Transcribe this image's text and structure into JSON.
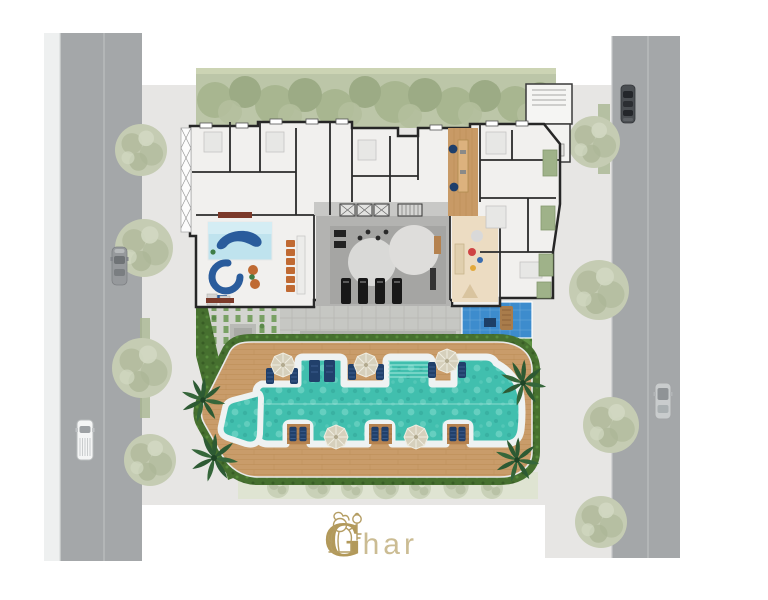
{
  "logo": {
    "initial": "G",
    "rest": "har",
    "icon": "lion-key-icon",
    "gold": "#b2995a",
    "gold_light": "#cbbc93"
  },
  "palette": {
    "road_asphalt": "#a4a7a9",
    "sidewalk": "#eef0f0",
    "site_ground": "#e7e6e4",
    "hedge_top": "#bcc6a8",
    "hedge_dark": "#46702f",
    "foliage_sage": "#c5ccb3",
    "deck_wood": "#c99c6a",
    "pool_water": "#41bfae",
    "pool_coping": "#eef2f2",
    "plunge_pool_blue": "#3d8ccd",
    "grass": "#5f9344",
    "building_wall": "#262626",
    "room_floor": "#f1f0ee",
    "core_gray": "#b3b3b1",
    "furniture_navy": "#21406b",
    "furniture_orange": "#bf6a33",
    "kids_mat_blue": "#bfe3ee",
    "playroom_beige": "#ecdcc2",
    "umbrella_beige": "#d6d0bc",
    "accent_red_planter": "#7c3a2a"
  },
  "counts": {
    "cars": 4,
    "umbrellas_top": 3,
    "umbrellas_bottom": 2,
    "lounger_platforms": 3,
    "treadmills": 4
  }
}
